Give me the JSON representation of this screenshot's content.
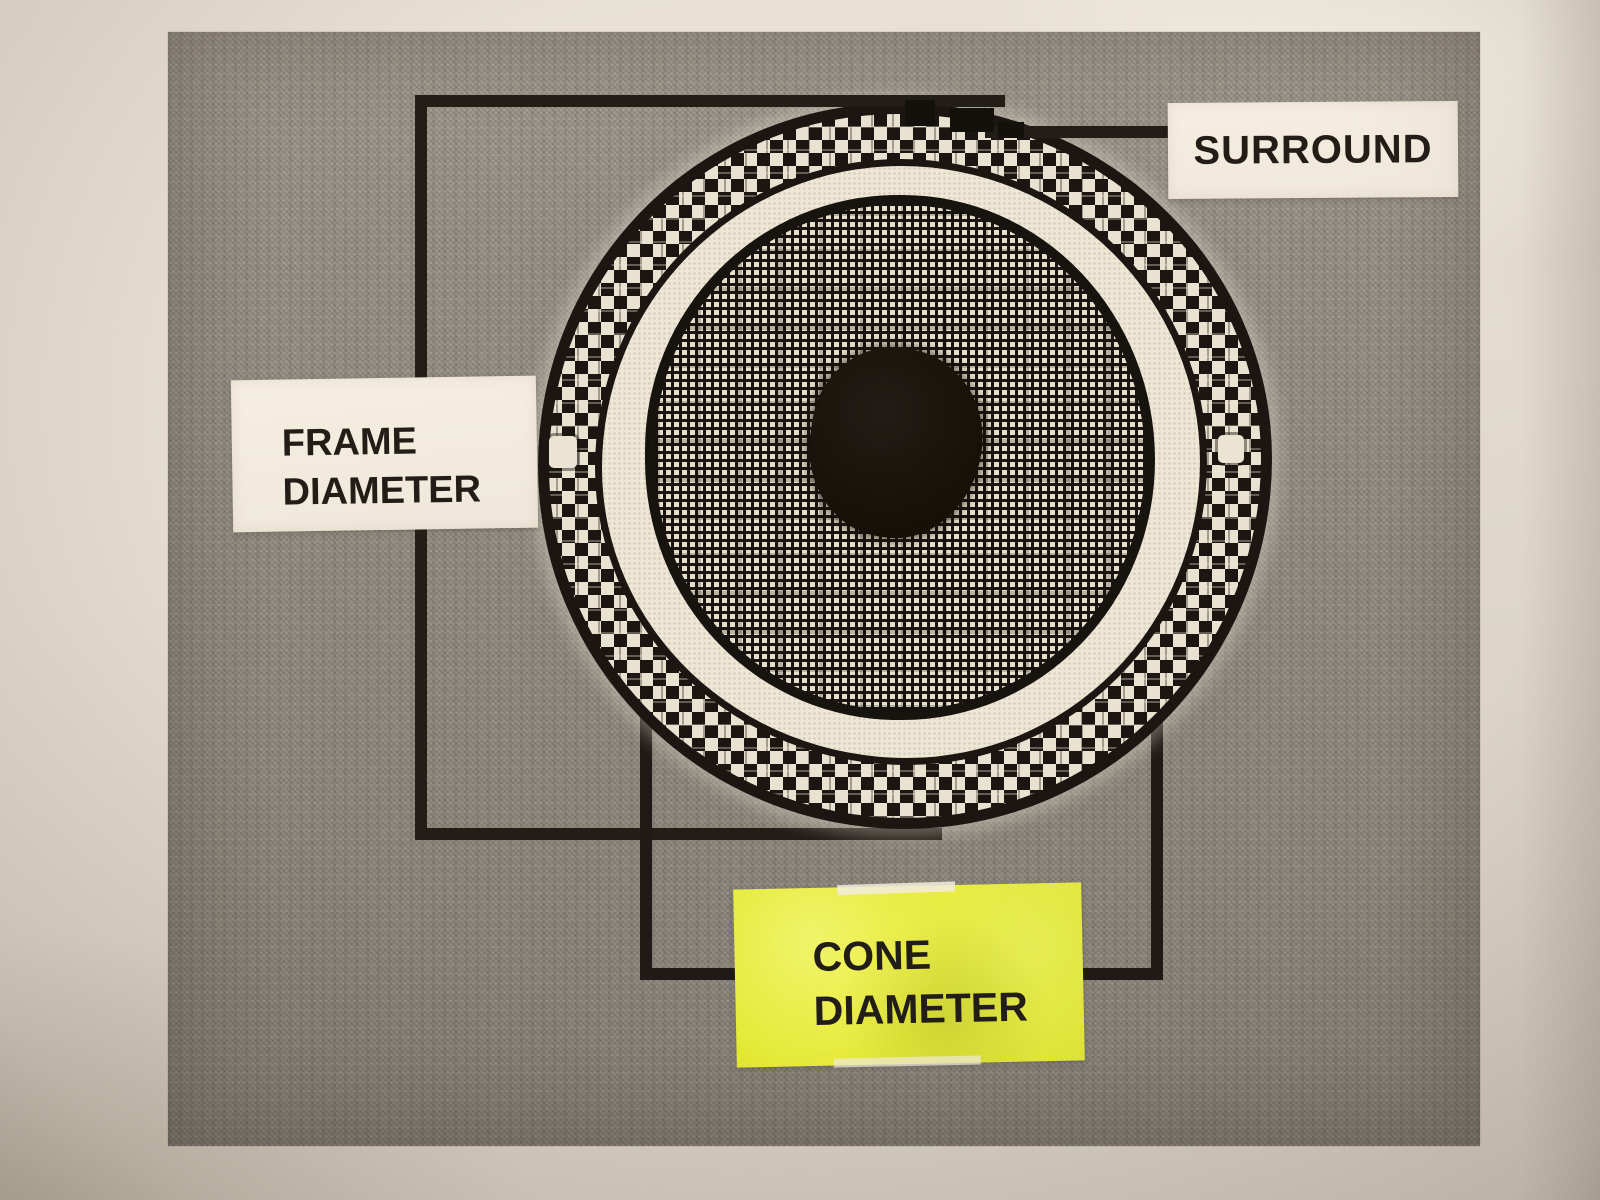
{
  "figure": {
    "labels": {
      "surround": {
        "text": "SURROUND"
      },
      "frame_diameter": {
        "line1": "FRAME",
        "line2": "DIAMETER"
      },
      "cone_diameter": {
        "line1": "CONE",
        "line2": "DIAMETER"
      }
    },
    "colors": {
      "photo_paper": "#e3dccf",
      "printed_gray": "#958f85",
      "ink_black": "#221d17",
      "label_white": "#f2ebdd",
      "label_yellow": "#e7eb35",
      "halftone_cream": "#eae2d1"
    }
  }
}
